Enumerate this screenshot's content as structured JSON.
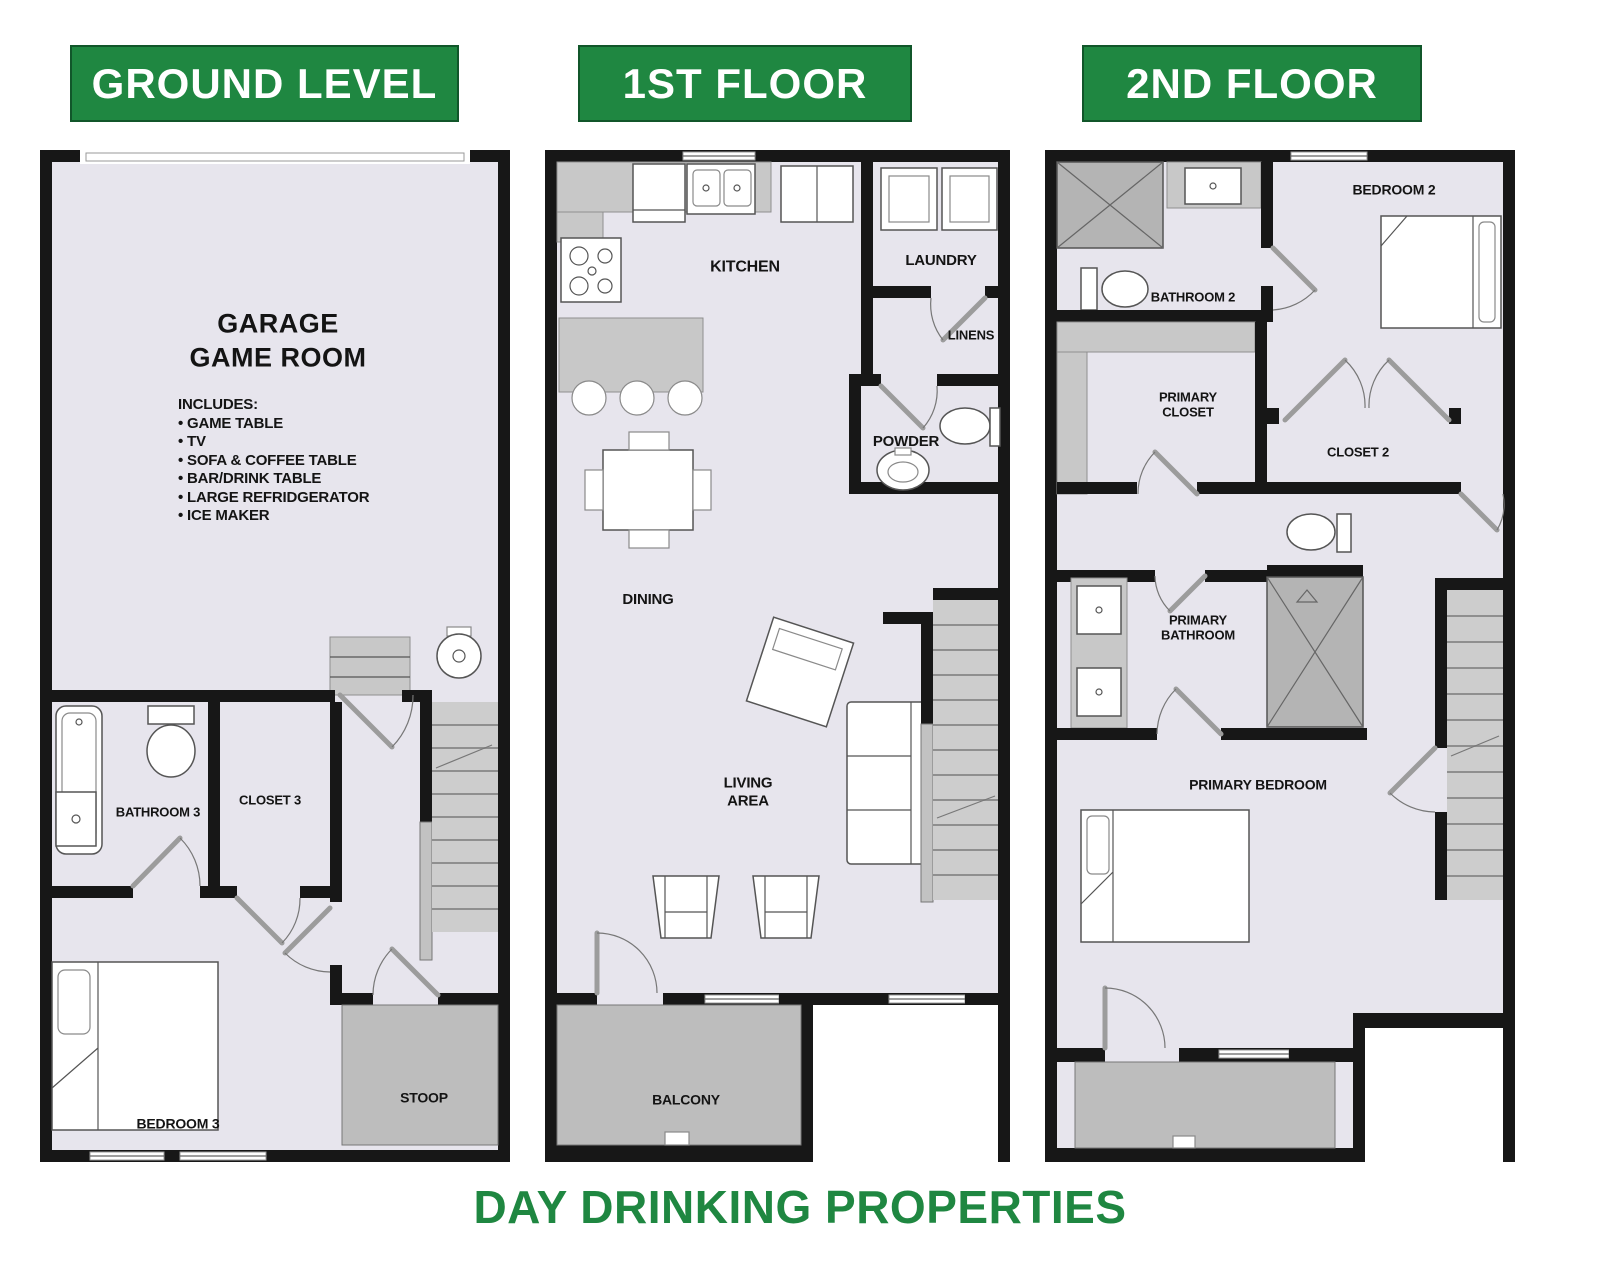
{
  "page": {
    "footer": "DAY DRINKING PROPERTIES"
  },
  "colors": {
    "accent": "#1f8741",
    "accent_border": "#11562a",
    "wall": "#171717",
    "floor": "#e7e5ed",
    "gray": "#c8c8c8",
    "stair": "#cdcdcd",
    "shower": "#b4b4b4",
    "balcony": "#bdbdbd",
    "line": "#555555"
  },
  "floors": {
    "ground": {
      "header": "GROUND LEVEL",
      "garage_title": "GARAGE\nGAME ROOM",
      "includes_heading": "INCLUDES:",
      "includes": [
        "• GAME TABLE",
        "• TV",
        "• SOFA & COFFEE TABLE",
        "• BAR/DRINK TABLE",
        "• LARGE REFRIDGERATOR",
        "• ICE MAKER"
      ],
      "rooms": {
        "bathroom3": "BATHROOM 3",
        "closet3": "CLOSET 3",
        "bedroom3": "BEDROOM 3",
        "stoop": "STOOP"
      }
    },
    "first": {
      "header": "1ST FLOOR",
      "rooms": {
        "kitchen": "KITCHEN",
        "laundry": "LAUNDRY",
        "linens": "LINENS",
        "powder": "POWDER",
        "dining": "DINING",
        "living_area": "LIVING\nAREA",
        "balcony": "BALCONY"
      }
    },
    "second": {
      "header": "2ND FLOOR",
      "rooms": {
        "bathroom2": "BATHROOM 2",
        "bedroom2": "BEDROOM 2",
        "primary_closet": "PRIMARY\nCLOSET",
        "closet2": "CLOSET 2",
        "primary_bathroom": "PRIMARY\nBATHROOM",
        "primary_bedroom": "PRIMARY BEDROOM"
      }
    }
  }
}
